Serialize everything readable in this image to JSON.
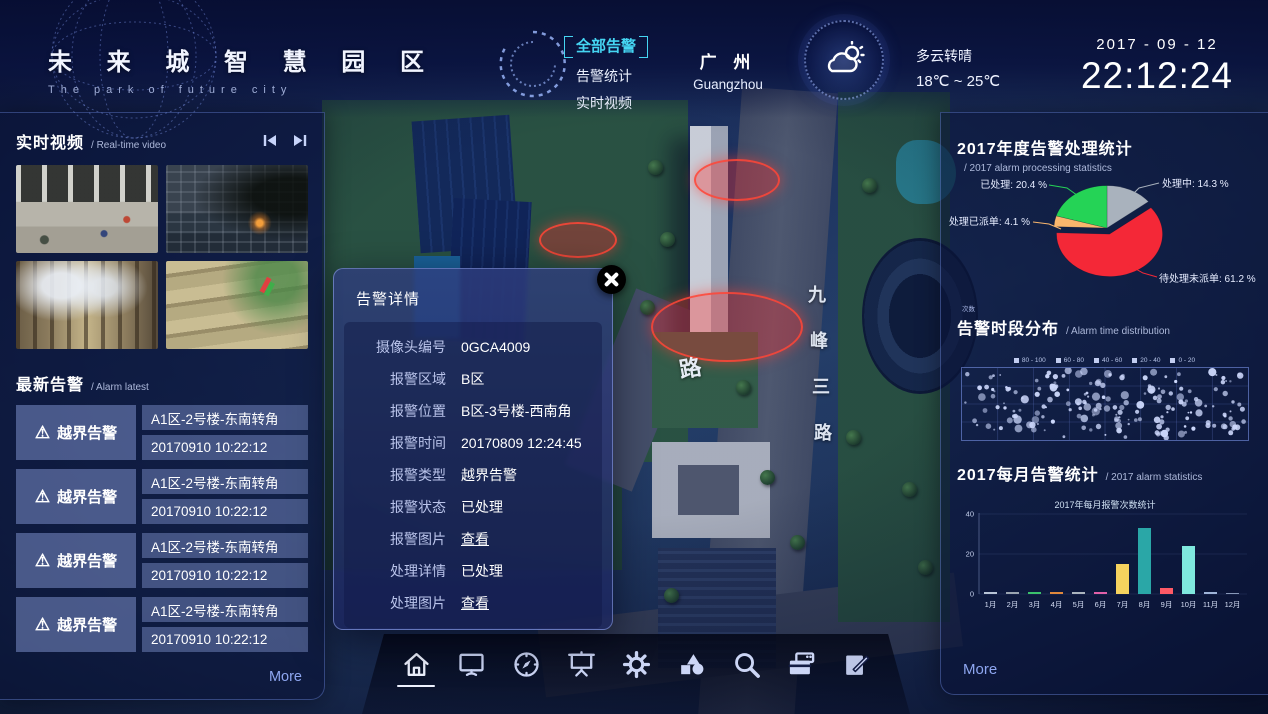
{
  "header": {
    "logo_title": "未 来 城 智 慧 园 区",
    "logo_subtitle": "The park of future city",
    "nav": [
      {
        "label": "全部告警",
        "active": true
      },
      {
        "label": "告警统计",
        "active": false
      },
      {
        "label": "实时视频",
        "active": false
      }
    ],
    "city_cn": "广 州",
    "city_en": "Guangzhou",
    "weather": {
      "condition": "多云转晴",
      "temp_range": "18℃ ~ 25℃"
    },
    "date": "2017 - 09 - 12",
    "time": "22:12:24",
    "accent_color": "#45d5f2"
  },
  "left_panel": {
    "video_section": {
      "title": "实时视频",
      "subtitle": "/ Real-time video",
      "thumbnails": [
        {
          "scene": "street"
        },
        {
          "scene": "building-dusk"
        },
        {
          "scene": "atrium"
        },
        {
          "scene": "stairs"
        }
      ]
    },
    "alarm_section": {
      "title": "最新告警",
      "subtitle": "/ Alarm latest",
      "items": [
        {
          "type": "越界告警",
          "location": "A1区-2号楼-东南转角",
          "time": "20170910 10:22:12"
        },
        {
          "type": "越界告警",
          "location": "A1区-2号楼-东南转角",
          "time": "20170910 10:22:12"
        },
        {
          "type": "越界告警",
          "location": "A1区-2号楼-东南转角",
          "time": "20170910 10:22:12"
        },
        {
          "type": "越界告警",
          "location": "A1区-2号楼-东南转角",
          "time": "20170910 10:22:12"
        }
      ]
    },
    "more_label": "More"
  },
  "modal": {
    "title": "告警详情",
    "fields": [
      {
        "label": "摄像头编号",
        "value": "0GCA4009",
        "link": false
      },
      {
        "label": "报警区域",
        "value": "B区",
        "link": false
      },
      {
        "label": "报警位置",
        "value": "B区-3号楼-西南角",
        "link": false
      },
      {
        "label": "报警时间",
        "value": "20170809 12:24:45",
        "link": false
      },
      {
        "label": "报警类型",
        "value": "越界告警",
        "link": false
      },
      {
        "label": "报警状态",
        "value": "已处理",
        "link": false
      },
      {
        "label": "报警图片",
        "value": "查看",
        "link": true
      },
      {
        "label": "处理详情",
        "value": "已处理",
        "link": false
      },
      {
        "label": "处理图片",
        "value": "查看",
        "link": true
      }
    ]
  },
  "right_panel": {
    "more_label": "More"
  },
  "chart_data": [
    {
      "type": "pie",
      "title": "2017年度告警处理统计",
      "subtitle": "/ 2017 alarm processing statistics",
      "direction": "clockwise-from-top",
      "slices": [
        {
          "name": "处理中",
          "pct": 14.3,
          "color": "#a9b2bd",
          "label": "处理中: 14.3 %",
          "exploded": false
        },
        {
          "name": "待处理未派单",
          "pct": 61.2,
          "color": "#f42837",
          "label": "待处理未派单: 61.2 %",
          "exploded": true
        },
        {
          "name": "待处理已派单",
          "pct": 4.1,
          "color": "#f9b66d",
          "label": "待处理已派单: 4.1 %",
          "exploded": false
        },
        {
          "name": "已处理",
          "pct": 20.4,
          "color": "#25d356",
          "label": "已处理: 20.4 %",
          "exploded": false
        }
      ]
    },
    {
      "type": "scatter",
      "title": "告警时段分布",
      "subtitle": "/ Alarm time distribution",
      "axis_label": "次数",
      "legend": [
        "80 - 100",
        "60 - 80",
        "40 - 60",
        "20 - 40",
        "0 - 20"
      ],
      "point_count": 190,
      "seed": 7,
      "dot_color": "#ccd7fb",
      "note": "dense random distribution of alarm counts across 24h grid"
    },
    {
      "type": "bar",
      "title": "2017每月告警统计",
      "subtitle": "/ 2017 alarm statistics",
      "inner_title": "2017年每月报警次数统计",
      "categories": [
        "1月",
        "2月",
        "3月",
        "4月",
        "5月",
        "6月",
        "7月",
        "8月",
        "9月",
        "10月",
        "11月",
        "12月"
      ],
      "values": [
        1,
        1,
        1,
        1,
        1,
        1,
        15,
        33,
        3,
        24,
        1,
        0.5
      ],
      "colors": [
        "#b8c4d6",
        "#9aa5b1",
        "#3bc16c",
        "#e0883c",
        "#aab4be",
        "#e060a8",
        "#f6d35e",
        "#2aa7a7",
        "#ff5a66",
        "#7fe8de",
        "#9fb4d8",
        "#8898b8"
      ],
      "ylim": [
        0,
        40
      ],
      "yticks": [
        0,
        20,
        40
      ]
    }
  ],
  "map": {
    "road_labels_vertical": [
      "九",
      "峰",
      "三",
      "路"
    ],
    "road_label_left": "路",
    "alert_markers": [
      {
        "x": 737,
        "y": 180,
        "w": 86,
        "h": 42
      },
      {
        "x": 578,
        "y": 240,
        "w": 78,
        "h": 36
      },
      {
        "x": 727,
        "y": 327,
        "w": 152,
        "h": 70
      }
    ]
  },
  "toolbar": {
    "items": [
      {
        "name": "home",
        "active": true
      },
      {
        "name": "monitor",
        "active": false
      },
      {
        "name": "compass",
        "active": false
      },
      {
        "name": "screen",
        "active": false
      },
      {
        "name": "gear",
        "active": false
      },
      {
        "name": "shapes",
        "active": false
      },
      {
        "name": "search",
        "active": false
      },
      {
        "name": "cards",
        "active": false
      },
      {
        "name": "edit",
        "active": false
      }
    ]
  }
}
